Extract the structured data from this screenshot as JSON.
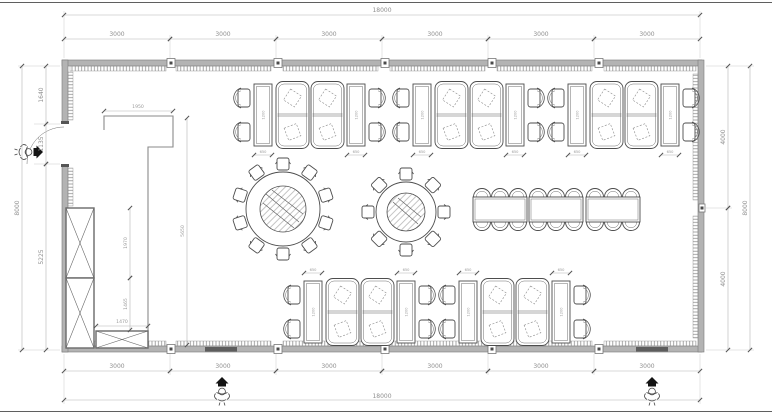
{
  "plan": {
    "dims": {
      "top_total": "18000",
      "bottom_total": "18000",
      "top_segments": [
        "3000",
        "3000",
        "3000",
        "3000",
        "3000",
        "3000"
      ],
      "bottom_segments": [
        "3000",
        "3000",
        "3000",
        "3000",
        "3000",
        "3000"
      ],
      "left_segments": [
        "1640",
        "1135",
        "5225"
      ],
      "left_total": "8000",
      "right_segments": [
        "4000",
        "4000"
      ],
      "right_total": "8000",
      "counter_width": "1950",
      "counter_length": "5650",
      "cabinet_upper": "1970",
      "cabinet_lower": "1465",
      "cabinet_bottom_width": "1470",
      "booth": {
        "table_width": "650",
        "table_length": "1200"
      }
    },
    "furniture": {
      "booth_modules_top": 3,
      "booth_modules_bottom": 2,
      "round_table_large_seats": 10,
      "round_table_small_seats": 8,
      "banquet_table_seats": 18
    },
    "colors": {
      "wall": "#b3b3b3",
      "furniture_line": "#4d4d4d",
      "dim_text": "#8f8f8f"
    }
  }
}
